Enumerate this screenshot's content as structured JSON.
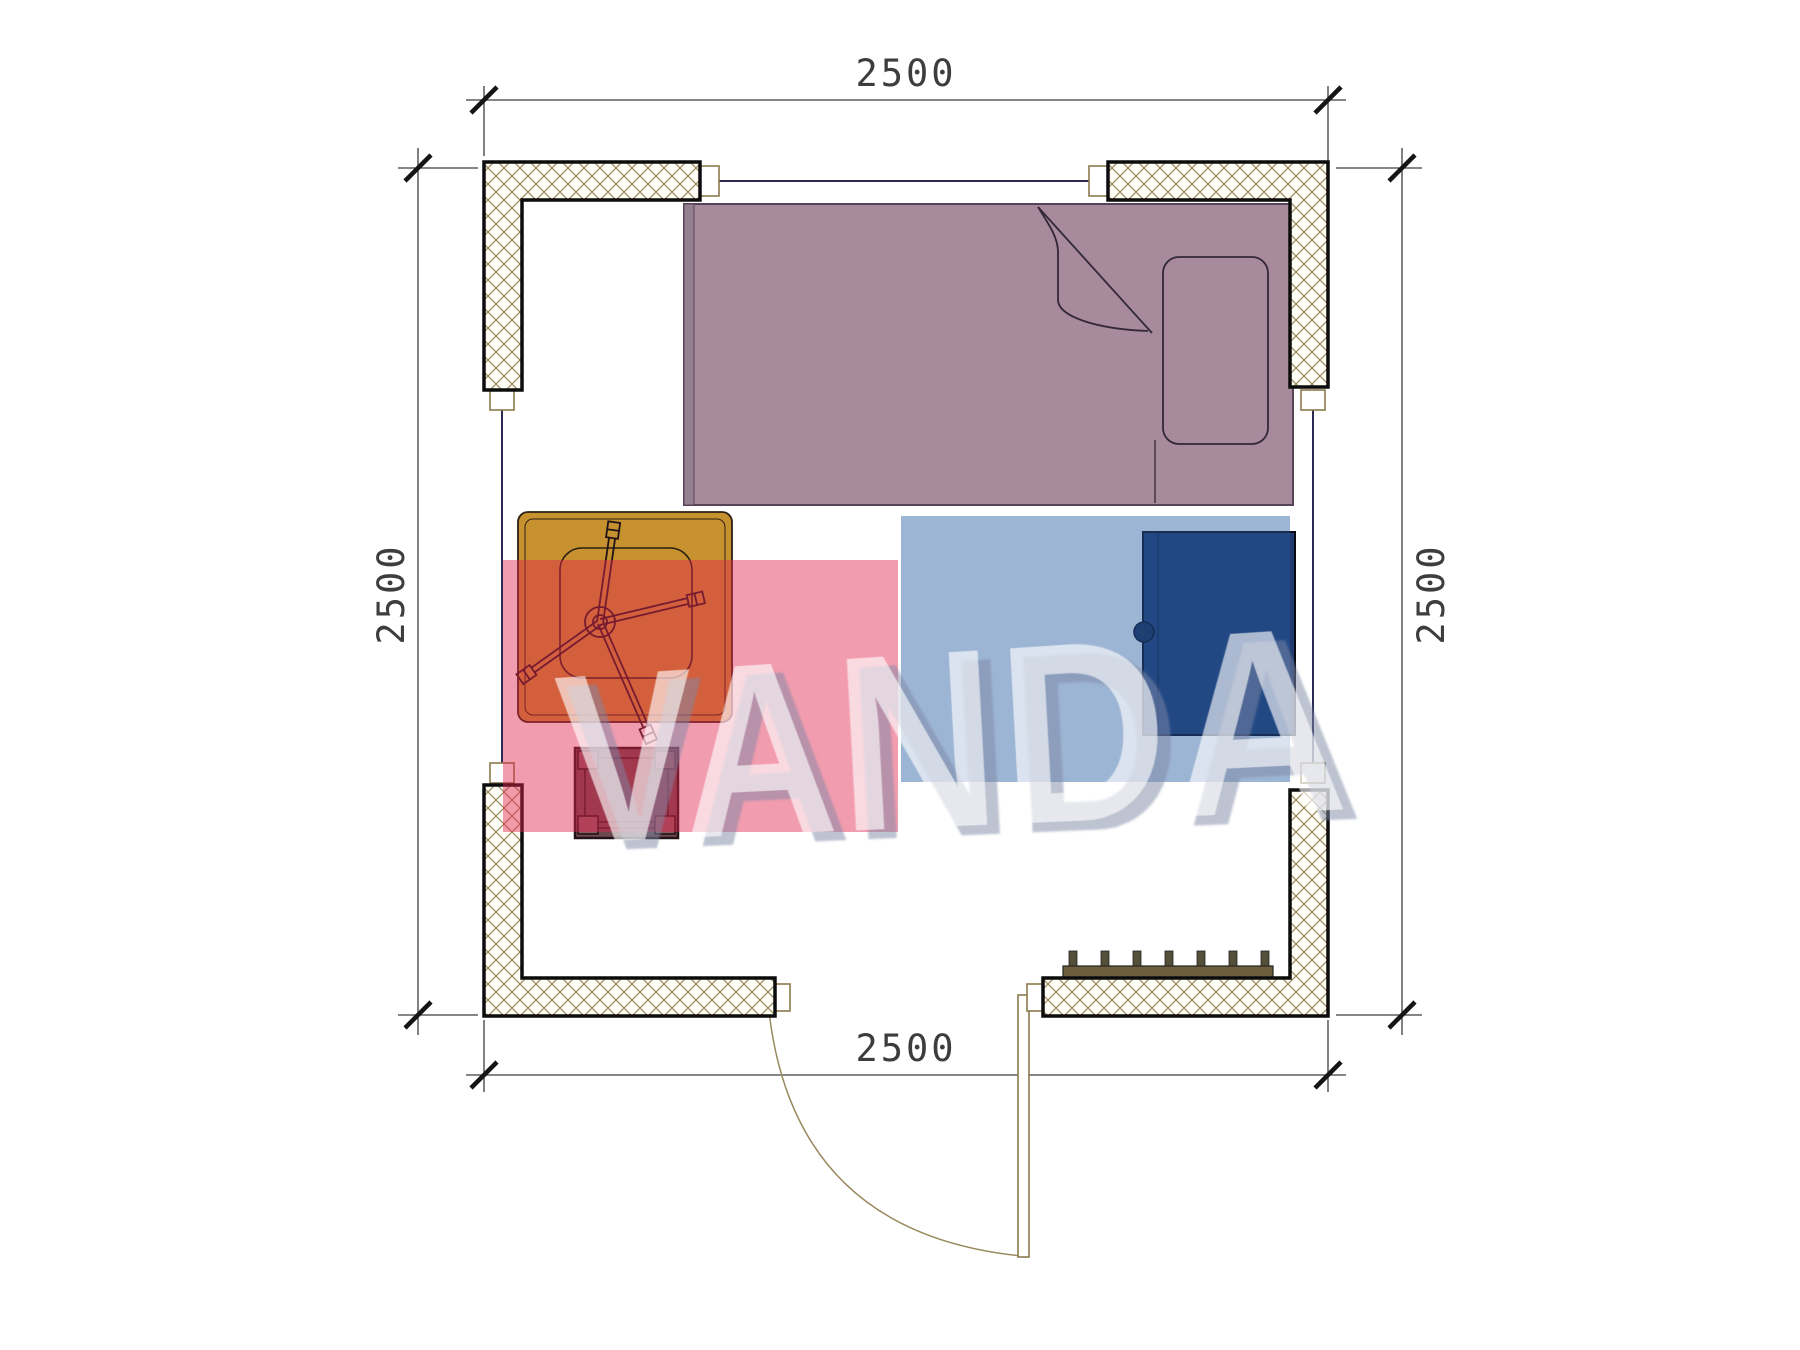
{
  "page": {
    "title": "Cabin room floor plan with furniture",
    "background": "#ffffff"
  },
  "dimensions": {
    "top": "2500",
    "bottom": "2500",
    "left": "2500",
    "right": "2500"
  },
  "watermark": {
    "text": "VANDA",
    "pink_block_color": "rgba(226,36,77,0.45)",
    "blue_block_color": "rgba(37,92,160,0.45)",
    "text_color": "rgba(255,255,255,0.62)"
  },
  "room": {
    "wall_fill": "#fdfcf5",
    "wall_hatch_color": "#9b8a5f",
    "wall_outline": "#0c0c0c",
    "window_line_color": "#2a2a55",
    "dimension_line_color": "#3d3d3d"
  },
  "furniture": {
    "bed": {
      "name": "single-bed",
      "fill": "#a78a9b"
    },
    "pillow": {
      "name": "pillow"
    },
    "desk": {
      "name": "desk",
      "fill": "#c8912f"
    },
    "chair": {
      "name": "office-chair-base"
    },
    "stool": {
      "name": "stool",
      "fill": "#6e4a4e"
    },
    "wardrobe": {
      "name": "wardrobe",
      "fill": "#1f3a6e"
    },
    "radiator": {
      "name": "radiator",
      "fill": "#6b5f3e",
      "fin_count": 7
    },
    "door": {
      "name": "entrance-door",
      "swing": "opens-inward-down"
    }
  }
}
